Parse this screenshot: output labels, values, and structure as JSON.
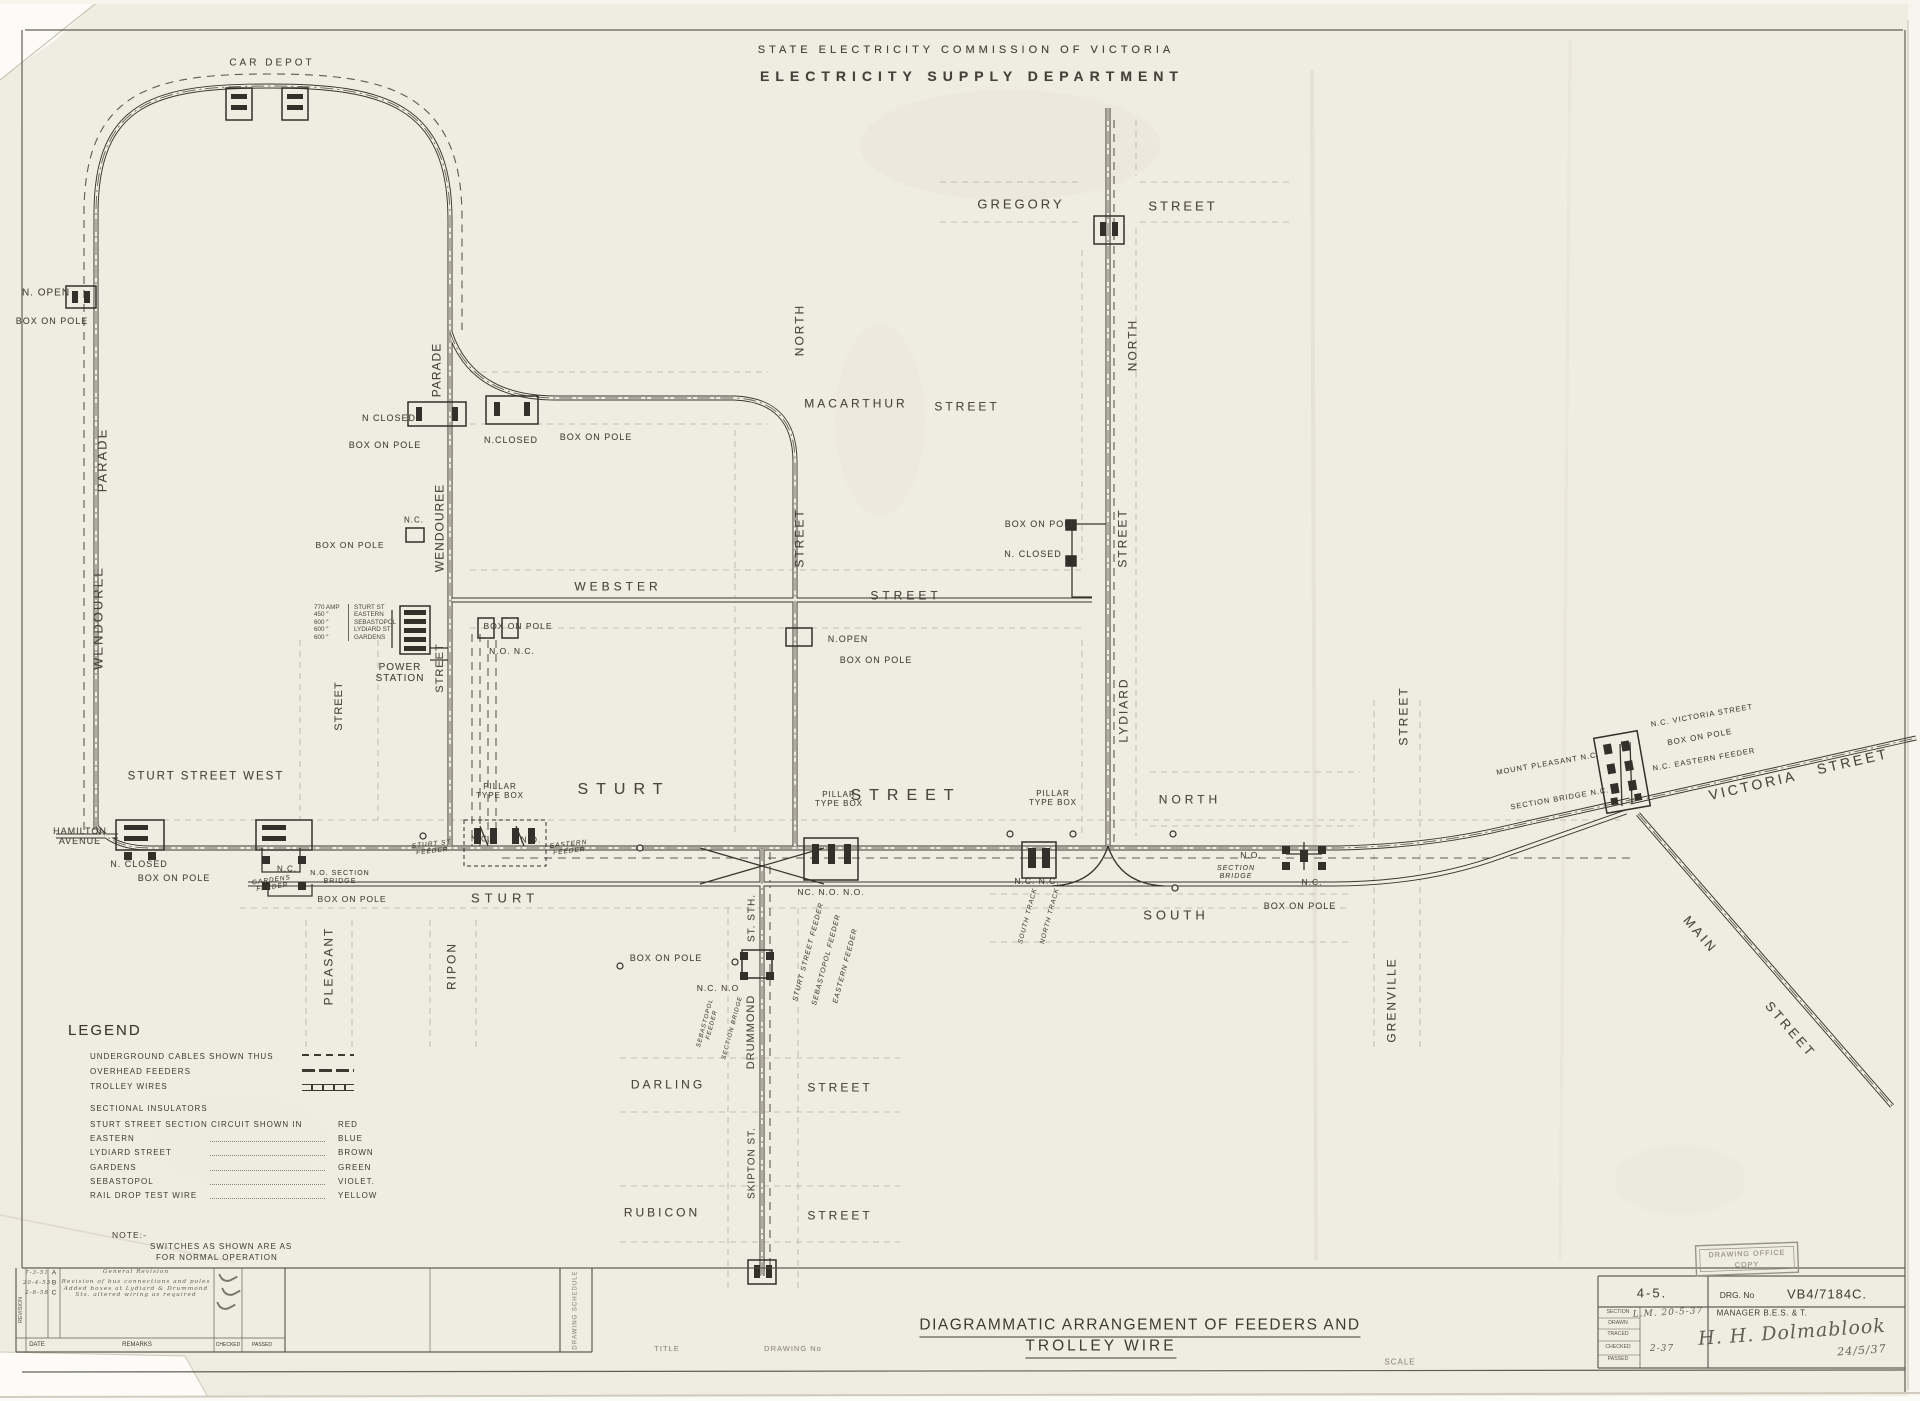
{
  "colors": {
    "paper": "#efece1",
    "ink": "#3a362e",
    "faded_ink": "#8a8476",
    "outline_gray": "#a29c8e"
  },
  "header": {
    "line1": "STATE ELECTRICITY COMMISSION OF VICTORIA",
    "line2": "ELECTRICITY SUPPLY DEPARTMENT"
  },
  "bottom": {
    "title1": "DIAGRAMMATIC ARRANGEMENT OF FEEDERS AND",
    "title2": "TROLLEY WIRE"
  },
  "title_block": {
    "sheet": "4-5.",
    "drg_label": "DRG. No",
    "drg_no": "VB4/7184C.",
    "row_labels": [
      "SECTION",
      "DRAWN",
      "TRACED",
      "CHECKED",
      "PASSED"
    ],
    "hand_drawn": "L.M.  20-5-37",
    "hand_checked": "2-37",
    "manager_label": "MANAGER B.E.S. & T.",
    "signature": "H. H. Dolmablook",
    "sign_date": "24/5/37",
    "stamp_line1": "DRAWING OFFICE",
    "stamp_line2": "COPY"
  },
  "revision_table": {
    "vertical_label": "REVISION",
    "date_label": "DATE",
    "remarks_label": "REMARKS",
    "checked_label": "CHECKED",
    "passed_label": "PASSED",
    "rows": [
      {
        "date": "7-3-51",
        "rev": "A",
        "remark": "General Revision"
      },
      {
        "date": "20-4-53",
        "rev": "B",
        "remark": "Revision of bus connections and poles"
      },
      {
        "date": "2-8-58",
        "rev": "C",
        "remark": "Added boxes at Lydiard & Drummond Sts. altered wiring as required"
      }
    ]
  },
  "power_station": {
    "feeders": [
      {
        "amps": "770 AMP",
        "name": "STURT ST"
      },
      {
        "amps": "450 ″",
        "name": "EASTERN"
      },
      {
        "amps": "600 ″",
        "name": "SEBASTOPOL"
      },
      {
        "amps": "600 ″",
        "name": "LYDIARD ST"
      },
      {
        "amps": "600 ″",
        "name": "GARDENS"
      }
    ]
  },
  "legend": {
    "heading": "LEGEND",
    "line_rows": [
      {
        "label": "UNDERGROUND CABLES SHOWN THUS",
        "swatch": "dash"
      },
      {
        "label": "OVERHEAD FEEDERS",
        "swatch": "feeder"
      },
      {
        "label": "TROLLEY WIRES",
        "swatch": "trolley"
      }
    ],
    "insulators_heading": "SECTIONAL INSULATORS",
    "circuit_rows": [
      {
        "item": "STURT STREET SECTION CIRCUIT SHOWN IN",
        "color": "RED"
      },
      {
        "item": "EASTERN",
        "color": "BLUE"
      },
      {
        "item": "LYDIARD STREET",
        "color": "BROWN"
      },
      {
        "item": "GARDENS",
        "color": "GREEN"
      },
      {
        "item": "SEBASTOPOL",
        "color": "VIOLET."
      },
      {
        "item": "RAIL DROP TEST WIRE",
        "color": "YELLOW"
      }
    ],
    "note_label": "NOTE:-",
    "note_line1": "SWITCHES AS SHOWN ARE AS",
    "note_line2": "FOR NORMAL OPERATION"
  },
  "diagram": {
    "labels": [
      {
        "n": "car-depot-label",
        "t": "CAR DEPOT",
        "x": 272,
        "y": 63,
        "s": 10,
        "ls": 3
      },
      {
        "n": "n-open-label",
        "t": "N. OPEN",
        "x": 46,
        "y": 293,
        "s": 10
      },
      {
        "n": "box-on-pole-nw",
        "t": "BOX ON POLE",
        "x": 52,
        "y": 321,
        "s": 9
      },
      {
        "n": "parade-west-label",
        "t": "PARADE",
        "x": 103,
        "y": 460,
        "s": 13,
        "ls": 2,
        "r": -90
      },
      {
        "n": "wendouree-west-label",
        "t": "WENDOUREE",
        "x": 99,
        "y": 618,
        "s": 13,
        "ls": 2,
        "r": -90
      },
      {
        "n": "parade-east-label",
        "t": "PARADE",
        "x": 437,
        "y": 370,
        "s": 12,
        "ls": 1,
        "r": -90
      },
      {
        "n": "wendouree-east-label",
        "t": "WENDOUREE",
        "x": 440,
        "y": 528,
        "s": 12,
        "ls": 1,
        "r": -90
      },
      {
        "n": "n-closed-loop",
        "t": "N CLOSED",
        "x": 389,
        "y": 418,
        "s": 9
      },
      {
        "n": "box-on-pole-loop",
        "t": "BOX ON POLE",
        "x": 385,
        "y": 445,
        "s": 9
      },
      {
        "n": "n-closed-2",
        "t": "N.CLOSED",
        "x": 511,
        "y": 440,
        "s": 9
      },
      {
        "n": "box-on-pole-2",
        "t": "BOX ON POLE",
        "x": 596,
        "y": 437,
        "s": 9
      },
      {
        "n": "nc-wendouree",
        "t": "N.C.",
        "x": 414,
        "y": 521,
        "s": 8
      },
      {
        "n": "box-on-pole-3",
        "t": "BOX ON POLE",
        "x": 350,
        "y": 546,
        "s": 8.5
      },
      {
        "n": "north-drummond-label",
        "t": "NORTH",
        "x": 800,
        "y": 330,
        "s": 12,
        "ls": 2,
        "r": -90
      },
      {
        "n": "macarthur-label",
        "t": "MACARTHUR",
        "x": 856,
        "y": 404,
        "s": 12,
        "ls": 3
      },
      {
        "n": "macarthur-street-label",
        "t": "STREET",
        "x": 967,
        "y": 407,
        "s": 12,
        "ls": 3
      },
      {
        "n": "street-drummond-n-label",
        "t": "STREET",
        "x": 800,
        "y": 538,
        "s": 12,
        "ls": 2,
        "r": -90
      },
      {
        "n": "webster-label",
        "t": "WEBSTER",
        "x": 618,
        "y": 587,
        "s": 12,
        "ls": 4
      },
      {
        "n": "webster-street-label",
        "t": "STREET",
        "x": 906,
        "y": 596,
        "s": 12,
        "ls": 4
      },
      {
        "n": "n-open-drummond",
        "t": "N.OPEN",
        "x": 848,
        "y": 639,
        "s": 9
      },
      {
        "n": "box-on-pole-drummond",
        "t": "BOX ON POLE",
        "x": 876,
        "y": 660,
        "s": 9
      },
      {
        "n": "box-on-pole-ps",
        "t": "BOX ON POLE",
        "x": 518,
        "y": 627,
        "s": 8.5
      },
      {
        "n": "no-nc-ps",
        "t": "N.O. N.C.",
        "x": 512,
        "y": 652,
        "s": 8.5
      },
      {
        "n": "gregory-label",
        "t": "GREGORY",
        "x": 1021,
        "y": 205,
        "s": 13,
        "ls": 3
      },
      {
        "n": "gregory-street-label",
        "t": "STREET",
        "x": 1183,
        "y": 207,
        "s": 13,
        "ls": 3
      },
      {
        "n": "north-lydiard-label",
        "t": "NORTH",
        "x": 1133,
        "y": 345,
        "s": 12,
        "ls": 2,
        "r": -90
      },
      {
        "n": "box-on-pole-lydiard",
        "t": "BOX ON POLE",
        "x": 1041,
        "y": 524,
        "s": 9
      },
      {
        "n": "n-closed-lydiard",
        "t": "N. CLOSED",
        "x": 1033,
        "y": 554,
        "s": 9
      },
      {
        "n": "street-lydiard-label",
        "t": "STREET",
        "x": 1123,
        "y": 538,
        "s": 12,
        "ls": 2,
        "r": -90
      },
      {
        "n": "lydiard-label",
        "t": "LYDIARD",
        "x": 1124,
        "y": 710,
        "s": 12,
        "ls": 2,
        "r": -90
      },
      {
        "n": "power-station-label",
        "t": "POWER\nSTATION",
        "x": 400,
        "y": 673,
        "s": 10,
        "ls": 1
      },
      {
        "n": "street-ps-label",
        "t": "STREET",
        "x": 440,
        "y": 668,
        "s": 11,
        "ls": 1,
        "r": -90
      },
      {
        "n": "street-west-label",
        "t": "STREET",
        "x": 339,
        "y": 706,
        "s": 11,
        "ls": 1,
        "r": -90
      },
      {
        "n": "sturt-street-west-label",
        "t": "STURT  STREET  WEST",
        "x": 206,
        "y": 777,
        "s": 11.5,
        "ls": 2
      },
      {
        "n": "hamilton-avenue-label",
        "t": "HAMILTON\nAVENUE",
        "x": 80,
        "y": 836,
        "s": 9
      },
      {
        "n": "n-closed-hamilton",
        "t": "N. CLOSED",
        "x": 139,
        "y": 864,
        "s": 9
      },
      {
        "n": "box-on-pole-hamilton",
        "t": "BOX ON POLE",
        "x": 174,
        "y": 878,
        "s": 9
      },
      {
        "n": "nc-gardens",
        "t": "N.C.",
        "x": 287,
        "y": 870,
        "s": 8
      },
      {
        "n": "gardens-feeder-label",
        "t": "GARDENS\nFEEDER",
        "x": 272,
        "y": 884,
        "s": 6.5,
        "c": "it",
        "r": -8
      },
      {
        "n": "no-section-bridge",
        "t": "N.O. SECTION\nBRIDGE",
        "x": 340,
        "y": 878,
        "s": 7
      },
      {
        "n": "box-on-pole-gardens",
        "t": "BOX ON POLE",
        "x": 352,
        "y": 900,
        "s": 8.5
      },
      {
        "n": "pleasant-label",
        "t": "PLEASANT",
        "x": 329,
        "y": 966,
        "s": 12,
        "ls": 2,
        "r": -90
      },
      {
        "n": "ripon-label",
        "t": "RIPON",
        "x": 452,
        "y": 966,
        "s": 12,
        "ls": 2,
        "r": -90
      },
      {
        "n": "sturt-west-label",
        "t": "STURT",
        "x": 505,
        "y": 899,
        "s": 13,
        "ls": 5
      },
      {
        "n": "pillar-type-box-w",
        "t": "PILLAR\nTYPE BOX",
        "x": 500,
        "y": 792,
        "s": 8
      },
      {
        "n": "sturt-main-label",
        "t": "STURT",
        "x": 624,
        "y": 790,
        "s": 16,
        "ls": 8
      },
      {
        "n": "sturt-st-feeder-label",
        "t": "STURT ST\nFEEDER",
        "x": 432,
        "y": 848,
        "s": 6.5,
        "c": "it",
        "r": -6
      },
      {
        "n": "nc-sturt",
        "t": "N.C.",
        "x": 481,
        "y": 840,
        "s": 8
      },
      {
        "n": "no-sturt",
        "t": "N.O.",
        "x": 531,
        "y": 841,
        "s": 8
      },
      {
        "n": "eastern-feeder-label",
        "t": "EASTERN\nFEEDER",
        "x": 569,
        "y": 848,
        "s": 6.5,
        "c": "it",
        "r": -6
      },
      {
        "n": "pillar-type-box-c",
        "t": "PILLAR\nTYPE BOX",
        "x": 839,
        "y": 800,
        "s": 8
      },
      {
        "n": "street-main-label",
        "t": "STREET",
        "x": 906,
        "y": 796,
        "s": 16,
        "ls": 8
      },
      {
        "n": "nc-no-no-label",
        "t": "NC. N.O. N.O.",
        "x": 831,
        "y": 893,
        "s": 8.5
      },
      {
        "n": "st-sth-label",
        "t": "ST. STH.",
        "x": 752,
        "y": 918,
        "s": 10,
        "ls": 1,
        "r": -90
      },
      {
        "n": "sturt-street-feeder-r",
        "t": "STURT STREET FEEDER",
        "x": 809,
        "y": 952,
        "s": 7,
        "c": "it",
        "r": -75
      },
      {
        "n": "sebastopol-feeder-r",
        "t": "SEBASTOPOL FEEDER",
        "x": 827,
        "y": 960,
        "s": 7,
        "c": "it",
        "r": -75
      },
      {
        "n": "eastern-feeder-r",
        "t": "EASTERN FEEDER",
        "x": 846,
        "y": 966,
        "s": 7,
        "c": "it",
        "r": -75
      },
      {
        "n": "box-on-pole-drummond-s",
        "t": "BOX ON POLE",
        "x": 666,
        "y": 958,
        "s": 9
      },
      {
        "n": "nc-no-drummond",
        "t": "N.C. N.O",
        "x": 718,
        "y": 989,
        "s": 8.5
      },
      {
        "n": "sebastopol-feeder-s",
        "t": "SEBASTOPOL\nFEEDER",
        "x": 709,
        "y": 1024,
        "s": 6,
        "c": "it",
        "r": -75
      },
      {
        "n": "section-bridge-s",
        "t": "SECTION BRIDGE",
        "x": 733,
        "y": 1028,
        "s": 6,
        "c": "it",
        "r": -75
      },
      {
        "n": "drummond-s-label",
        "t": "DRUMMOND",
        "x": 751,
        "y": 1032,
        "s": 11,
        "ls": 1,
        "r": -90
      },
      {
        "n": "darling-label",
        "t": "DARLING",
        "x": 668,
        "y": 1085,
        "s": 12,
        "ls": 3
      },
      {
        "n": "darling-street-label",
        "t": "STREET",
        "x": 840,
        "y": 1088,
        "s": 12,
        "ls": 3
      },
      {
        "n": "skipton-label",
        "t": "SKIPTON ST.",
        "x": 752,
        "y": 1163,
        "s": 10,
        "ls": 1,
        "r": -90
      },
      {
        "n": "rubicon-label",
        "t": "RUBICON",
        "x": 662,
        "y": 1213,
        "s": 12,
        "ls": 3
      },
      {
        "n": "rubicon-street-label",
        "t": "STREET",
        "x": 840,
        "y": 1216,
        "s": 12,
        "ls": 3
      },
      {
        "n": "pillar-type-box-e",
        "t": "PILLAR\nTYPE BOX",
        "x": 1053,
        "y": 799,
        "s": 8
      },
      {
        "n": "north-sturt-label",
        "t": "NORTH",
        "x": 1190,
        "y": 800,
        "s": 12,
        "ls": 4
      },
      {
        "n": "nc-nc-lydiard",
        "t": "N.C. N.C.",
        "x": 1037,
        "y": 882,
        "s": 8.5
      },
      {
        "n": "south-track-label",
        "t": "SOUTH TRACK",
        "x": 1028,
        "y": 916,
        "s": 6.5,
        "c": "it",
        "r": -75
      },
      {
        "n": "north-track-label",
        "t": "NORTH TRACK",
        "x": 1050,
        "y": 916,
        "s": 6.5,
        "c": "it",
        "r": -75
      },
      {
        "n": "south-street-label",
        "t": "SOUTH",
        "x": 1176,
        "y": 916,
        "s": 13,
        "ls": 4
      },
      {
        "n": "no-bridge-e",
        "t": "N.O.",
        "x": 1251,
        "y": 856,
        "s": 8.5
      },
      {
        "n": "section-bridge-e",
        "t": "SECTION\nBRIDGE",
        "x": 1236,
        "y": 873,
        "s": 7,
        "c": "it"
      },
      {
        "n": "nc-bridge-e",
        "t": "N.C.",
        "x": 1312,
        "y": 883,
        "s": 8.5
      },
      {
        "n": "box-on-pole-e",
        "t": "BOX ON POLE",
        "x": 1300,
        "y": 906,
        "s": 9
      },
      {
        "n": "grenville-label",
        "t": "GRENVILLE",
        "x": 1392,
        "y": 1000,
        "s": 12,
        "ls": 2,
        "r": -90
      },
      {
        "n": "street-grenville-label",
        "t": "STREET",
        "x": 1404,
        "y": 716,
        "s": 12,
        "ls": 2,
        "r": -90
      },
      {
        "n": "mount-pleasant-label",
        "t": "MOUNT  PLEASANT  N.C.",
        "x": 1548,
        "y": 764,
        "s": 7.5,
        "r": -10
      },
      {
        "n": "section-bridge-v",
        "t": "SECTION BRIDGE N.C.",
        "x": 1560,
        "y": 799,
        "s": 7.5,
        "r": -10
      },
      {
        "n": "nc-victoria-label",
        "t": "N.C. VICTORIA  STREET",
        "x": 1702,
        "y": 716,
        "s": 7.5,
        "r": -10
      },
      {
        "n": "box-on-pole-v",
        "t": "BOX  ON  POLE",
        "x": 1700,
        "y": 738,
        "s": 8,
        "r": -10
      },
      {
        "n": "nc-eastern-v",
        "t": "N.C. EASTERN  FEEDER",
        "x": 1704,
        "y": 760,
        "s": 7.5,
        "r": -10
      },
      {
        "n": "victoria-label",
        "t": "VICTORIA",
        "x": 1753,
        "y": 786,
        "s": 14,
        "ls": 3,
        "r": -13
      },
      {
        "n": "victoria-street-label",
        "t": "STREET",
        "x": 1853,
        "y": 762,
        "s": 14,
        "ls": 3,
        "r": -13
      },
      {
        "n": "main-label",
        "t": "MAIN",
        "x": 1700,
        "y": 935,
        "s": 13,
        "ls": 3,
        "r": 49
      },
      {
        "n": "main-street-label",
        "t": "STREET",
        "x": 1790,
        "y": 1030,
        "s": 13,
        "ls": 3,
        "r": 49
      },
      {
        "n": "cell-title-label",
        "t": "TITLE",
        "x": 667,
        "y": 1349,
        "s": 7.5,
        "c": "fd"
      },
      {
        "n": "cell-drawing-no-label",
        "t": "DRAWING No",
        "x": 793,
        "y": 1349,
        "s": 7.5,
        "c": "fd"
      },
      {
        "n": "scale-label",
        "t": "SCALE",
        "x": 1400,
        "y": 1363,
        "s": 8,
        "c": "fd"
      },
      {
        "n": "drawing-schedule-label",
        "t": "DRAWING SCHEDULE",
        "x": 576,
        "y": 1310,
        "s": 6,
        "c": "fd",
        "r": -90
      }
    ]
  }
}
